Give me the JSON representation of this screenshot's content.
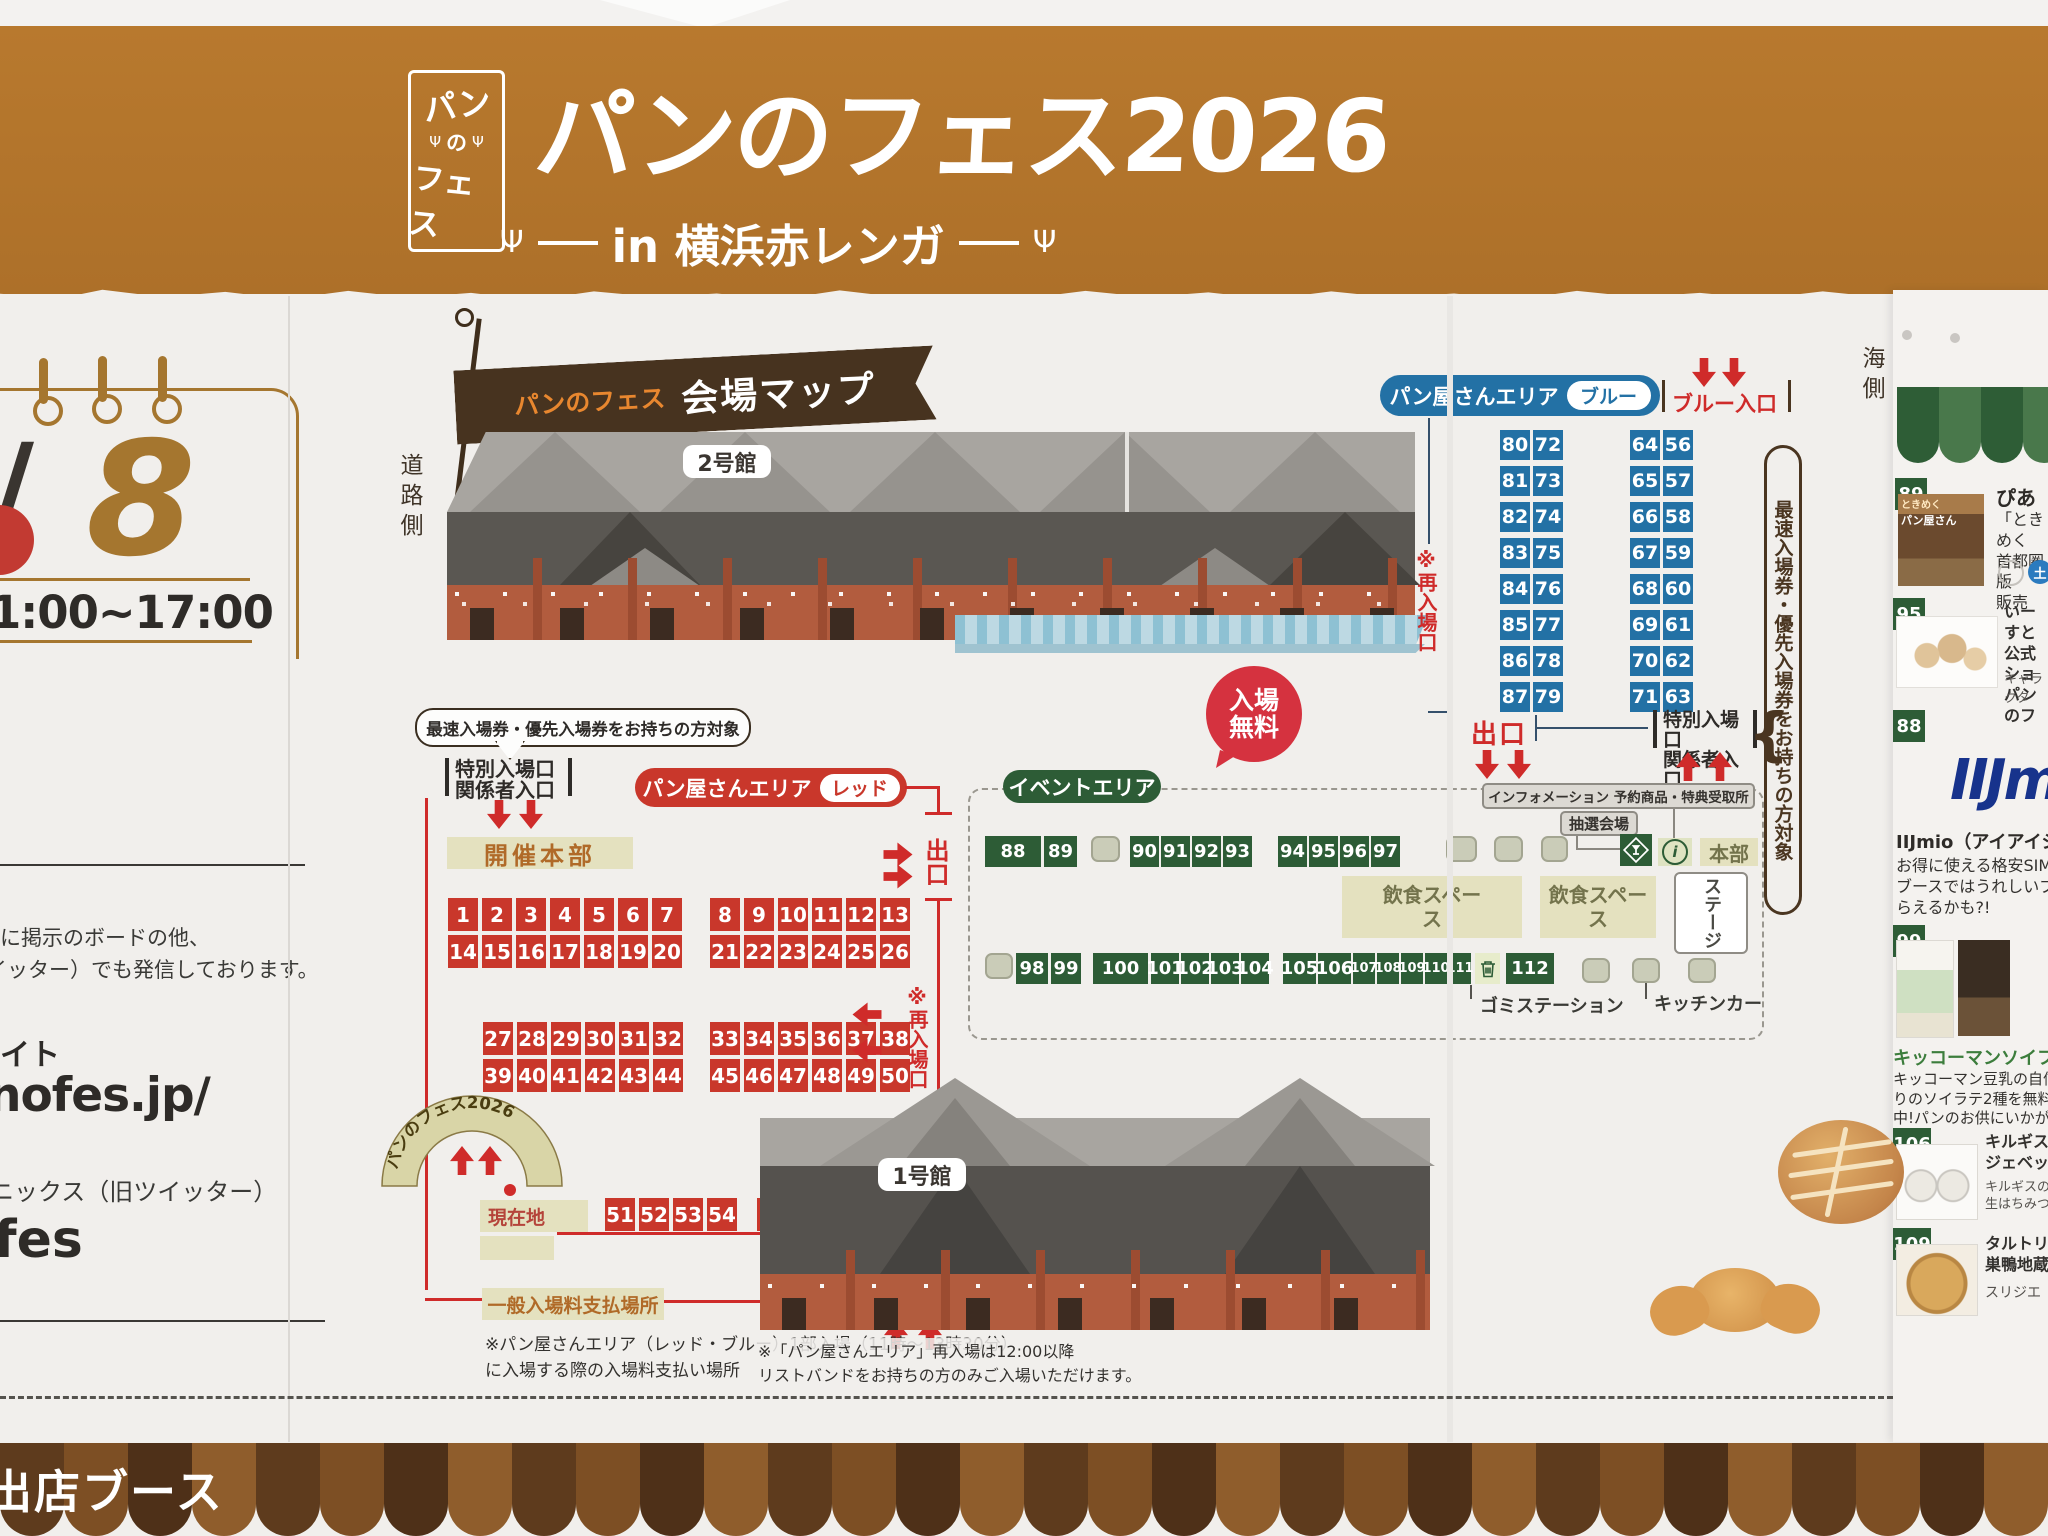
{
  "banner": {
    "logo_top": "パン",
    "logo_mid": "の",
    "logo_bottom": "フェス",
    "title": "パンのフェス2026",
    "subtitle": "in 横浜赤レンガ"
  },
  "left_panel": {
    "slash": "/",
    "day": "8",
    "time": "1:00~17:00",
    "note1": "に掲示のボードの他、",
    "note2": "イッター）でも発信しております。",
    "site_suffix": "イト",
    "url": "nofes.jp/",
    "sns": "ニックス（旧ツイッター）",
    "account": "fes"
  },
  "map": {
    "flag_logo": "パンのフェス",
    "flag_title": "会場マップ",
    "road_side": "道路側",
    "sea_side": "海側",
    "bldg2": "2号館",
    "bldg1": "1号館",
    "free1": "入場",
    "free2": "無料",
    "priority_note": "最速入場券・優先入場券をお持ちの方対象",
    "blue": {
      "area": "パン屋さんエリア",
      "tag": "ブルー",
      "entrance": "ブルー入口",
      "exit": "出口",
      "sp1": "特別入場口",
      "sp2": "関係者入口",
      "reentry": "※再入場口",
      "cols": [
        [
          "80",
          "81",
          "82",
          "83",
          "84",
          "85",
          "86",
          "87"
        ],
        [
          "72",
          "73",
          "74",
          "75",
          "76",
          "77",
          "78",
          "79"
        ],
        [
          "64",
          "65",
          "66",
          "67",
          "68",
          "69",
          "70",
          "71"
        ],
        [
          "56",
          "57",
          "58",
          "59",
          "60",
          "61",
          "62",
          "63"
        ]
      ]
    },
    "red": {
      "area": "パン屋さんエリア",
      "tag": "レッド",
      "sp1": "特別入場口",
      "sp2": "関係者入口",
      "hq": "開催本部",
      "exit": "出口",
      "reentry": "※再入場口",
      "entrance": "レッド入口",
      "pay": "一般入場料支払場所",
      "here": "現在地",
      "arch": "パンのフェス2026",
      "rows": {
        "a1": [
          "1",
          "2",
          "3",
          "4",
          "5",
          "6",
          "7"
        ],
        "a2": [
          "14",
          "15",
          "16",
          "17",
          "18",
          "19",
          "20"
        ],
        "b1": [
          "8",
          "9",
          "10",
          "11",
          "12",
          "13"
        ],
        "b2": [
          "21",
          "22",
          "23",
          "24",
          "25",
          "26"
        ],
        "c1": [
          "27",
          "28",
          "29",
          "30",
          "31",
          "32"
        ],
        "c2": [
          "39",
          "40",
          "41",
          "42",
          "43",
          "44"
        ],
        "d1": [
          "33",
          "34",
          "35",
          "36",
          "37",
          "38"
        ],
        "d2": [
          "45",
          "46",
          "47",
          "48",
          "49",
          "50"
        ],
        "e": [
          "51",
          "52",
          "53",
          "54"
        ]
      },
      "wide": "55",
      "note1": "※パン屋さんエリア（レッド・ブルー）1部入場（11時～13時30分）",
      "note2": "に入場する際の入場料支払い場所"
    },
    "event": {
      "area": "イベントエリア",
      "info": "インフォメーション 予約商品・特典受取所",
      "lottery": "抽選会場",
      "hq": "本部",
      "stage": "ステージ",
      "food": "飲食スペース",
      "trash": "ゴミステーション",
      "kitchen": "キッチンカー",
      "row1": [
        {
          "v": "88",
          "w": 56
        },
        {
          "v": "89",
          "w": 33,
          "ml": 3
        },
        {
          "ph": true,
          "w": 29,
          "ml": 14
        },
        {
          "v": "90",
          "w": 29,
          "ml": 10
        },
        {
          "v": "91",
          "w": 29,
          "ml": 2
        },
        {
          "v": "92",
          "w": 29,
          "ml": 2
        },
        {
          "v": "93",
          "w": 29,
          "ml": 2
        },
        {
          "v": "94",
          "w": 29,
          "ml": 26
        },
        {
          "v": "95",
          "w": 29,
          "ml": 2
        },
        {
          "v": "96",
          "w": 29,
          "ml": 2
        },
        {
          "v": "97",
          "w": 29,
          "ml": 2
        },
        {
          "ph": true,
          "w": 31,
          "ml": 46
        },
        {
          "ph": true,
          "w": 29,
          "ml": 17
        },
        {
          "ph": true,
          "w": 27,
          "ml": 18
        }
      ],
      "row2": [
        {
          "ph": true,
          "w": 28
        },
        {
          "v": "98",
          "w": 32,
          "ml": 3
        },
        {
          "v": "99",
          "w": 30,
          "ml": 3
        },
        {
          "v": "100",
          "w": 55,
          "ml": 12
        },
        {
          "v": "101",
          "w": 28,
          "ml": 3
        },
        {
          "v": "102",
          "w": 28,
          "ml": 2
        },
        {
          "v": "103",
          "w": 28,
          "ml": 2
        },
        {
          "v": "104",
          "w": 28,
          "ml": 2
        },
        {
          "v": "105",
          "w": 33,
          "ml": 14
        },
        {
          "v": "106",
          "w": 33,
          "ml": 2
        },
        {
          "v": "107",
          "w": 22,
          "ml": 2,
          "small": true
        },
        {
          "v": "108",
          "w": 22,
          "ml": 2,
          "small": true
        },
        {
          "v": "109",
          "w": 22,
          "ml": 2,
          "small": true
        },
        {
          "v": "110",
          "w": 22,
          "ml": 2,
          "small": true
        },
        {
          "v": "111",
          "w": 22,
          "ml": 2,
          "small": true
        },
        {
          "trash": true,
          "w": 25,
          "ml": 4
        },
        {
          "v": "112",
          "w": 48,
          "ml": 6
        }
      ]
    },
    "bldg1_note1": "※「パン屋さんエリア」再入場は12:00以降",
    "bldg1_note2": "リストバンドをお持ちの方のみご入場いただけます。"
  },
  "sidebar": {
    "entries": [
      {
        "num": "89",
        "title": "ぴあ",
        "cover1": "ときめく",
        "cover2": "パン屋さん",
        "desc": [
          "「ときめく",
          "首都圏版",
          "販売"
        ],
        "badge": "土"
      },
      {
        "num": "95",
        "t1": "いーすと",
        "t2": "公式ショ",
        "t3": "パンのフ",
        "desc": [
          "キャラクタ"
        ]
      },
      {
        "num": "88",
        "logo": "IIJmio",
        "title": "IIJmio（アイアイジェイ",
        "desc": [
          "お得に使える格安SIMをこ",
          "ブースではうれしいプレゼン",
          "らえるかも?!"
        ]
      },
      {
        "num": "99",
        "title": "キッコーマンソイフー",
        "desc": [
          "キッコーマン豆乳の自信作!",
          "りのソイラテ2種を無料プレ",
          "中!パンのお供にいかが?"
        ]
      },
      {
        "num": "106",
        "t1": "キルギスの白",
        "t2": "ジェベックジ",
        "desc": [
          "キルギスの白",
          "生はちみつ三"
        ]
      },
      {
        "num": "109",
        "t1": "タルトリア",
        "t2": "巣鴨地蔵通",
        "desc": [
          "スリジエ"
        ]
      }
    ]
  },
  "footer": {
    "label": "出店ブース"
  }
}
